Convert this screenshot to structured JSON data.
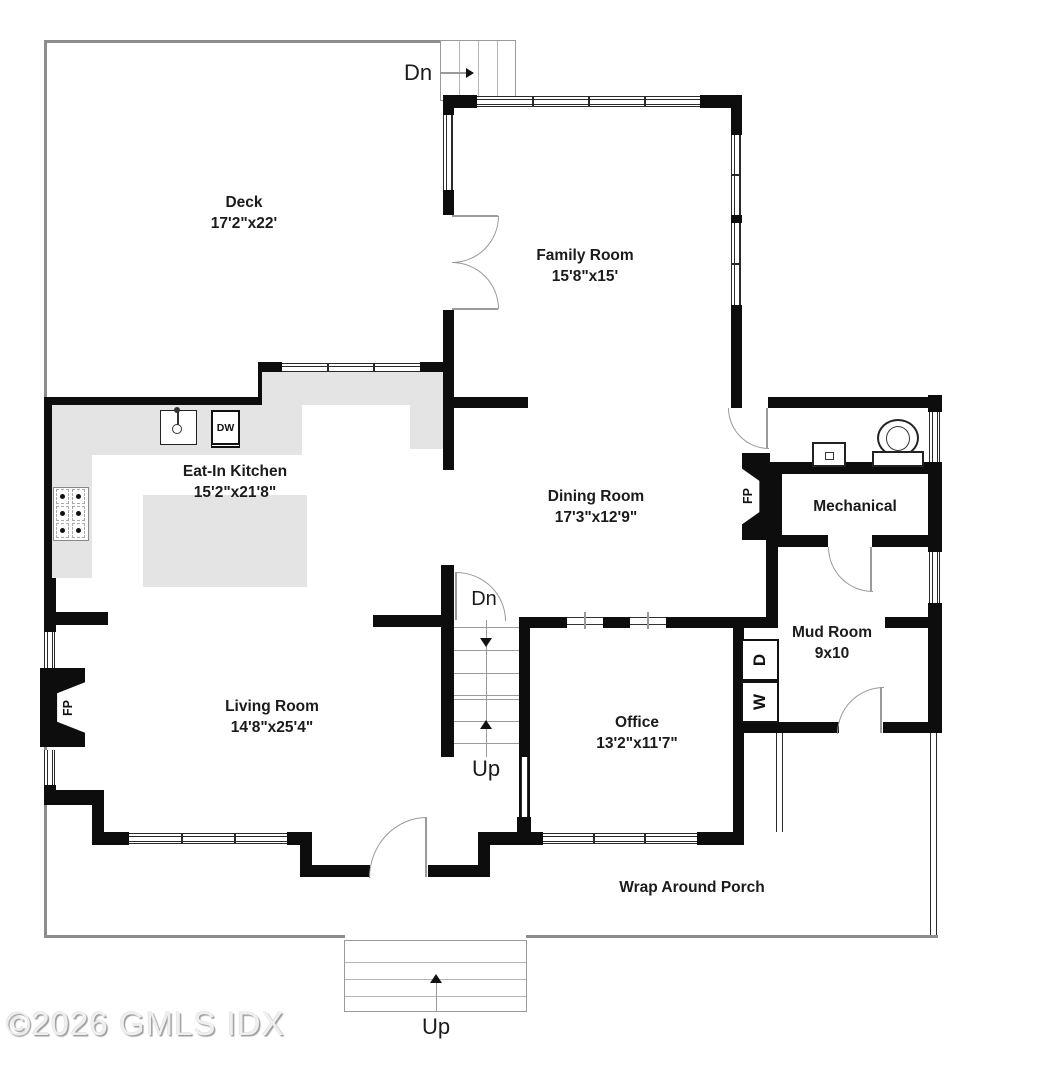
{
  "floorplan": {
    "watermark": "©2026 GMLS IDX",
    "rooms": [
      {
        "name": "Deck",
        "dims": "17'2\"x22'"
      },
      {
        "name": "Family Room",
        "dims": "15'8\"x15'"
      },
      {
        "name": "Eat-In Kitchen",
        "dims": "15'2\"x21'8\""
      },
      {
        "name": "Dining Room",
        "dims": "17'3\"x12'9\""
      },
      {
        "name": "Mechanical",
        "dims": ""
      },
      {
        "name": "Mud Room",
        "dims": "9x10"
      },
      {
        "name": "Living Room",
        "dims": "14'8\"x25'4\""
      },
      {
        "name": "Office",
        "dims": "13'2\"x11'7\""
      },
      {
        "name": "Wrap Around Porch",
        "dims": ""
      }
    ],
    "stairs": {
      "deck_down": "Dn",
      "center_down": "Dn",
      "center_up": "Up",
      "porch_up": "Up"
    },
    "appliances": {
      "dishwasher": "DW",
      "washer": "W",
      "dryer": "D"
    },
    "fireplace_label": "FP",
    "colors": {
      "wall": "#0d0d0d",
      "porch_line": "#8c8c8c",
      "counter": "#e4e4e4"
    }
  }
}
